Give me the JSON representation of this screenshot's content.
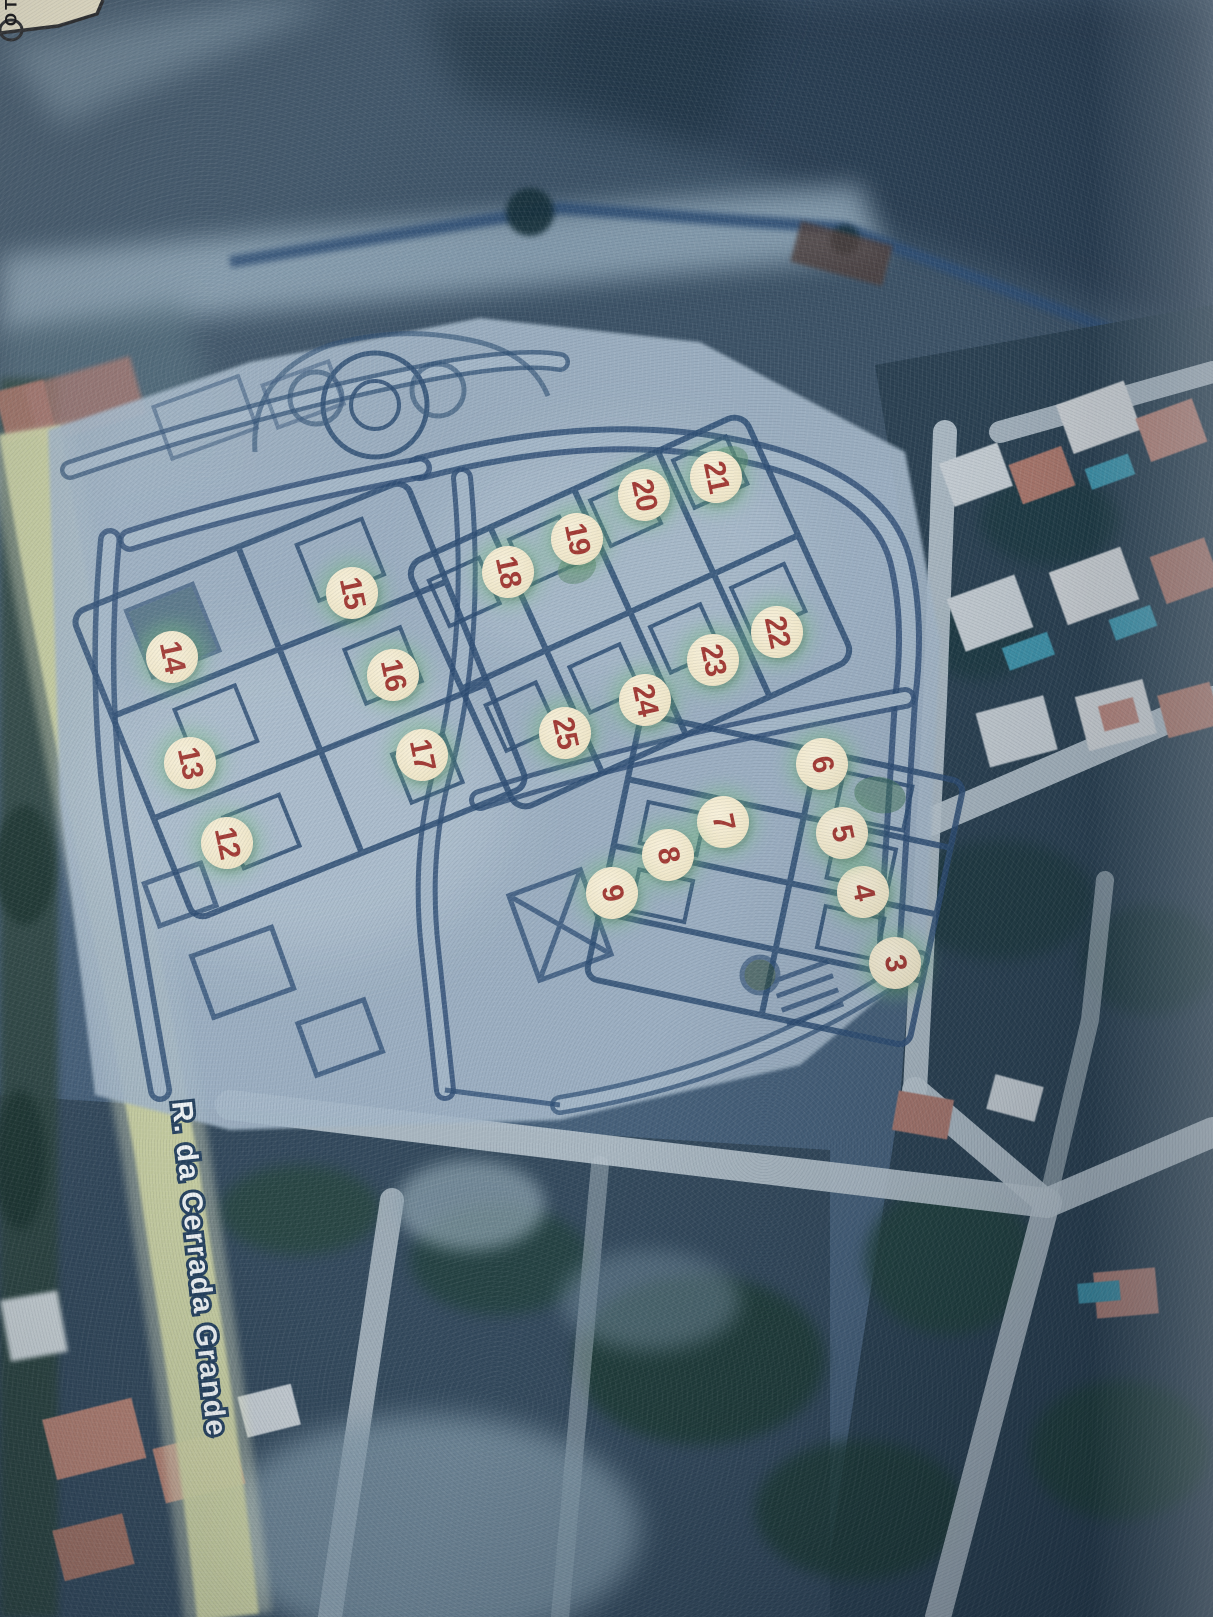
{
  "map": {
    "description": "Aerial photo of printed allotment plan over satellite imagery",
    "street_label": "R. da Cerrada Grande",
    "corner_label": "TO",
    "colors": {
      "marker_fill": "#efe6c8",
      "marker_number": "#a23a34",
      "marker_glow": "rgba(116,188,128,0.42)",
      "street_label_fill": "#edf1f3",
      "street_label_outline": "#25415e",
      "plan_ink": "#2e4e74",
      "plan_paper": "#a3b6c7"
    },
    "markers": [
      {
        "n": "3",
        "x": 895,
        "y": 963
      },
      {
        "n": "4",
        "x": 863,
        "y": 892
      },
      {
        "n": "5",
        "x": 842,
        "y": 833
      },
      {
        "n": "6",
        "x": 822,
        "y": 764
      },
      {
        "n": "7",
        "x": 723,
        "y": 822
      },
      {
        "n": "8",
        "x": 668,
        "y": 855
      },
      {
        "n": "9",
        "x": 612,
        "y": 893
      },
      {
        "n": "12",
        "x": 227,
        "y": 843
      },
      {
        "n": "13",
        "x": 190,
        "y": 763
      },
      {
        "n": "14",
        "x": 172,
        "y": 657
      },
      {
        "n": "15",
        "x": 352,
        "y": 593
      },
      {
        "n": "16",
        "x": 393,
        "y": 675
      },
      {
        "n": "17",
        "x": 422,
        "y": 755
      },
      {
        "n": "18",
        "x": 508,
        "y": 572
      },
      {
        "n": "19",
        "x": 577,
        "y": 539
      },
      {
        "n": "20",
        "x": 644,
        "y": 495
      },
      {
        "n": "21",
        "x": 716,
        "y": 477
      },
      {
        "n": "22",
        "x": 777,
        "y": 632
      },
      {
        "n": "23",
        "x": 713,
        "y": 660
      },
      {
        "n": "24",
        "x": 645,
        "y": 700
      },
      {
        "n": "25",
        "x": 565,
        "y": 733
      }
    ]
  }
}
